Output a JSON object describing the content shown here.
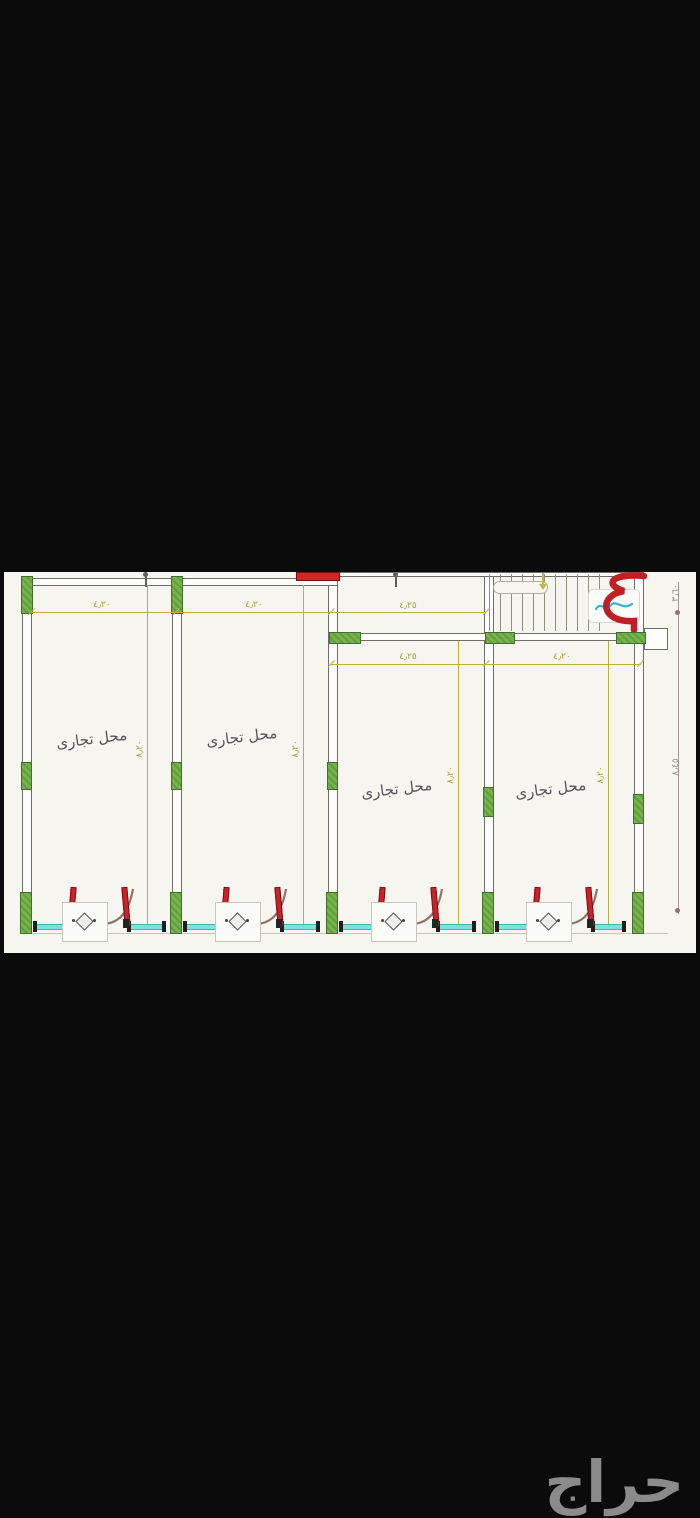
{
  "plan": {
    "shops": [
      {
        "label": "محل تجارى"
      },
      {
        "label": "محل تجارى"
      },
      {
        "label": "محل تجارى"
      },
      {
        "label": "محل تجارى"
      }
    ],
    "h_dims": [
      "٤٫٢٠",
      "٤٫٢٠",
      "٤٫٢٥",
      "٤٫٢٥",
      "٤٫٢٠"
    ],
    "v_dims": [
      "٨٫٢٠",
      "٨٫٢٠",
      "٨٫٢٠",
      "٨٫٢٠"
    ],
    "side_dims": [
      "٣٫٦٠",
      "٨٫٤٥"
    ]
  },
  "watermark": {
    "text": "حراج"
  },
  "colors": {
    "column_green": "#74b04b",
    "door_red": "#c6242a",
    "glass_cyan": "#79e4da",
    "dimension_olive": "#b9b13c",
    "tag_teal": "#35b4c6",
    "watermark_gray": "#8b8b8b"
  }
}
